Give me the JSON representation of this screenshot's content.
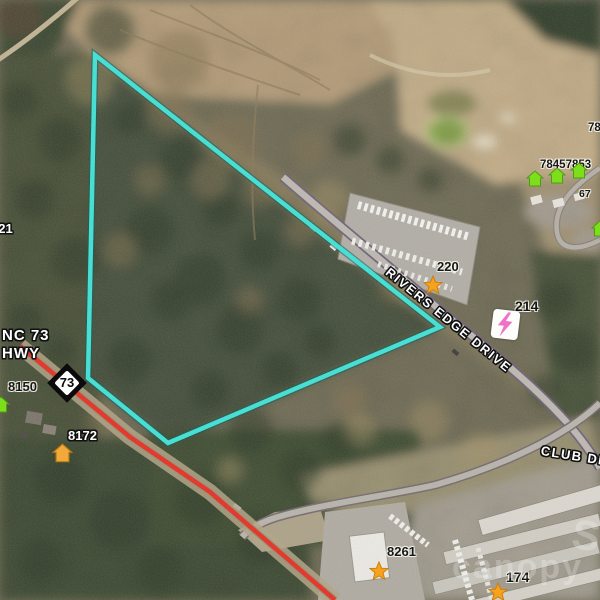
{
  "map_overlay": {
    "parcel_outline_color": "#3fe2d5",
    "highway_overlay_color": "#e53020",
    "route_shield_number": "73",
    "road_labels": {
      "rivers_edge": "RIVERS EDGE DRIVE",
      "club_drive": "CLUB DR",
      "highway_name_line1": "NC 73",
      "highway_name_line2": "HWY"
    },
    "address_labels": {
      "left_hwy": "8150",
      "left_hwy_south": "8172",
      "left_edge_partial": "121",
      "boat_lot": "220",
      "rivers_edge_parcel": "214",
      "bottom_building": "8261",
      "storage_facility": "174",
      "upper_right_cluster": "78457853",
      "upper_right_edge_partial": "78",
      "right_mid_partial": "67"
    },
    "marker_colors": {
      "poi_star": "#f6a21c",
      "listing_house_green": "#7ddf1c",
      "listing_house_orange": "#f2a93b",
      "utility_lightning": "#ee72c8"
    }
  },
  "watermark": {
    "text": "canopy",
    "swoosh_letter": "S"
  }
}
